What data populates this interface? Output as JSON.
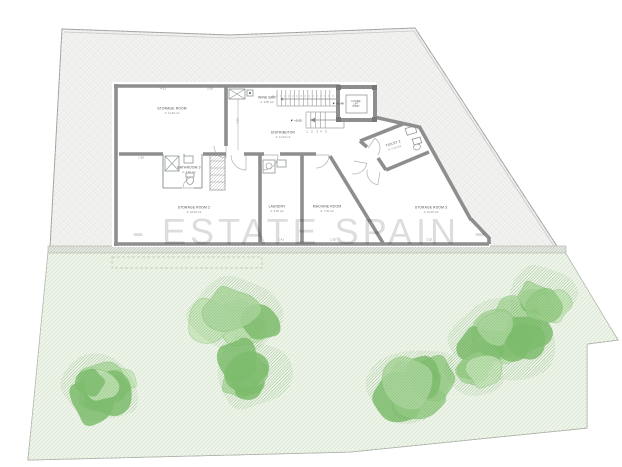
{
  "watermark": {
    "text": "- ESTATE SPAIN -"
  },
  "plan": {
    "rooms": [
      {
        "id": "storage-room",
        "label": "STORAGE ROOM",
        "area": "A: 14.60 m2",
        "x": 172,
        "y": 111,
        "rot": 0
      },
      {
        "id": "wine-bar",
        "label": "WINE BAR",
        "area": "A: 9.85 m2",
        "x": 267,
        "y": 100,
        "rot": 0
      },
      {
        "id": "distributor",
        "label": "DISTRIBUTOR",
        "area": "A: 11.20 m2",
        "x": 283,
        "y": 135,
        "rot": 0
      },
      {
        "id": "toilet-2",
        "label": "TOILET 2",
        "area": "A: 4.15 m2",
        "x": 394,
        "y": 146,
        "rot": -17
      },
      {
        "id": "bathroom-3",
        "label": "BATHROOM 3",
        "area": "A: 3.60 m2",
        "x": 189,
        "y": 170,
        "rot": 0
      },
      {
        "id": "storage-room-2",
        "label": "STORAGE ROOM 2",
        "area": "A: 18.40 m2",
        "x": 194,
        "y": 210,
        "rot": 0
      },
      {
        "id": "laundry",
        "label": "LAUNDRY",
        "area": "A: 6.30 m2",
        "x": 277,
        "y": 209,
        "rot": 0
      },
      {
        "id": "machine-room",
        "label": "MACHINE ROOM",
        "area": "A: 7.45 m2",
        "x": 327,
        "y": 209,
        "rot": 0
      },
      {
        "id": "storage-room-3",
        "label": "STORAGE ROOM 3",
        "area": "A: 16.20 m2",
        "x": 431,
        "y": 210,
        "rot": 0
      }
    ],
    "lift": {
      "lines": [
        "FUTURE",
        "LIFT",
        "SHAFT"
      ],
      "x": 356,
      "y": 104
    },
    "stair_numbers": [
      "1",
      "2",
      "3",
      "4",
      "5"
    ],
    "levels": [
      {
        "x": 338,
        "y": 104,
        "text": "+1.48"
      },
      {
        "x": 296,
        "y": 121,
        "text": "+0.00"
      }
    ],
    "dimensions": [
      {
        "x": 163,
        "y": 89,
        "text": "4.31",
        "rot": 0
      },
      {
        "x": 210,
        "y": 89,
        "text": "2.05",
        "rot": 0
      },
      {
        "x": 238,
        "y": 121,
        "text": "3.96",
        "rot": -90
      },
      {
        "x": 141,
        "y": 158,
        "text": "1.90",
        "rot": 0
      },
      {
        "x": 281,
        "y": 240,
        "text": "1.41",
        "rot": 0
      },
      {
        "x": 333,
        "y": 240,
        "text": "1.35",
        "rot": 0
      },
      {
        "x": 429,
        "y": 240,
        "text": "3.25",
        "rot": 0
      }
    ]
  },
  "garden": {
    "trees": [
      {
        "x": 100,
        "y": 385,
        "size": 46,
        "blobs": 7,
        "seed": 1
      },
      {
        "x": 238,
        "y": 316,
        "size": 52,
        "blobs": 8,
        "seed": 2
      },
      {
        "x": 250,
        "y": 372,
        "size": 42,
        "blobs": 7,
        "seed": 3
      },
      {
        "x": 411,
        "y": 384,
        "size": 50,
        "blobs": 8,
        "seed": 4
      },
      {
        "x": 506,
        "y": 339,
        "size": 56,
        "blobs": 9,
        "seed": 5
      },
      {
        "x": 541,
        "y": 296,
        "size": 38,
        "blobs": 6,
        "seed": 6
      },
      {
        "x": 477,
        "y": 368,
        "size": 34,
        "blobs": 5,
        "seed": 7
      }
    ]
  },
  "colors": {
    "site_fill": "#f3f3f1",
    "site_line": "#e4e4e1",
    "boundary": "#9c9c9c",
    "boundary_inner": "#c9c9c9",
    "grass_fill": "#f0f5ec",
    "grass_line": "#d3e2ca",
    "band_fill": "#e4e7df",
    "band_line": "#adb3a8",
    "tree_base": "#aed7a0",
    "tree_mid": "#96cb86",
    "tree_dark": "#7fbd6f",
    "tree_light": "#c6e4b9",
    "tree_line": "#6fae61",
    "wall": "#8e8e8e",
    "line_thin": "#9a9e9e",
    "fixture": "#8f9698",
    "stair": "#a2a6a6",
    "label": "#4a4a4a",
    "dim": "#8a8a8a",
    "watermark": "#d2d2d2"
  }
}
